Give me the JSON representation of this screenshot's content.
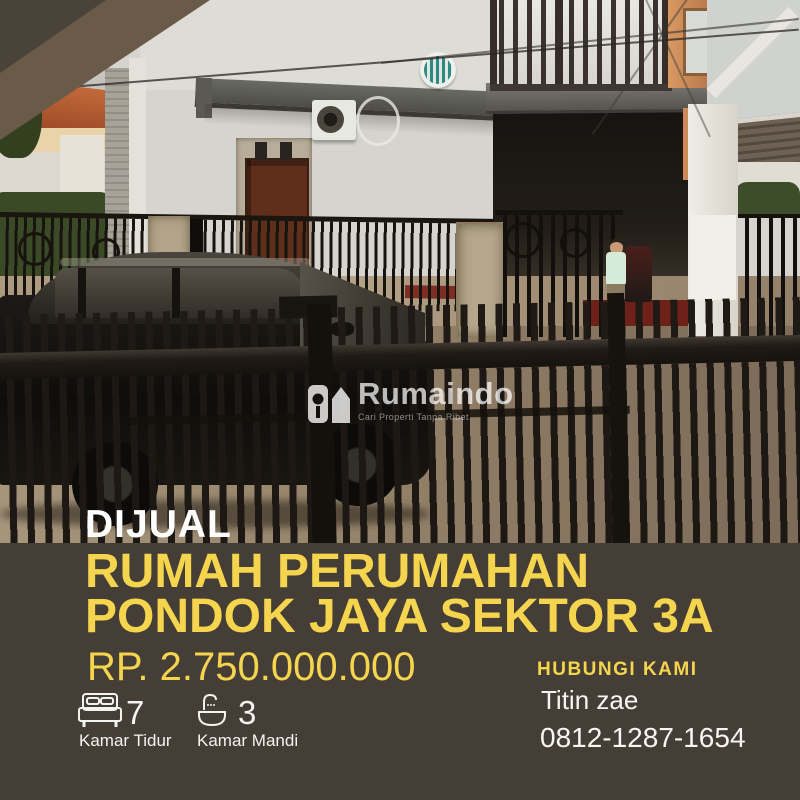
{
  "flyer": {
    "badge": "DIJUAL",
    "title_line1": "RUMAH PERUMAHAN",
    "title_line2": "PONDOK JAYA SEKTOR 3A",
    "price": "RP. 2.750.000.000",
    "features": [
      {
        "icon": "bed-icon",
        "value": "7",
        "label": "Kamar Tidur"
      },
      {
        "icon": "bath-icon",
        "value": "3",
        "label": "Kamar Mandi"
      }
    ],
    "contact": {
      "heading": "HUBUNGI KAMI",
      "name": "Titin zae",
      "phone": "0812-1287-1654"
    }
  },
  "watermark": {
    "icon": "rumaindo-house-key-icon",
    "brand": "Rumaindo",
    "tagline": "Cari Properti Tanpa Ribet"
  },
  "theme": {
    "accent_yellow": "#F5D44E",
    "panel_brown": "#453E37",
    "corner_light": "#6A5B48",
    "corner_dark": "#4A4339",
    "text_white": "#FFFFFF",
    "fence_black": "#1D1813"
  }
}
